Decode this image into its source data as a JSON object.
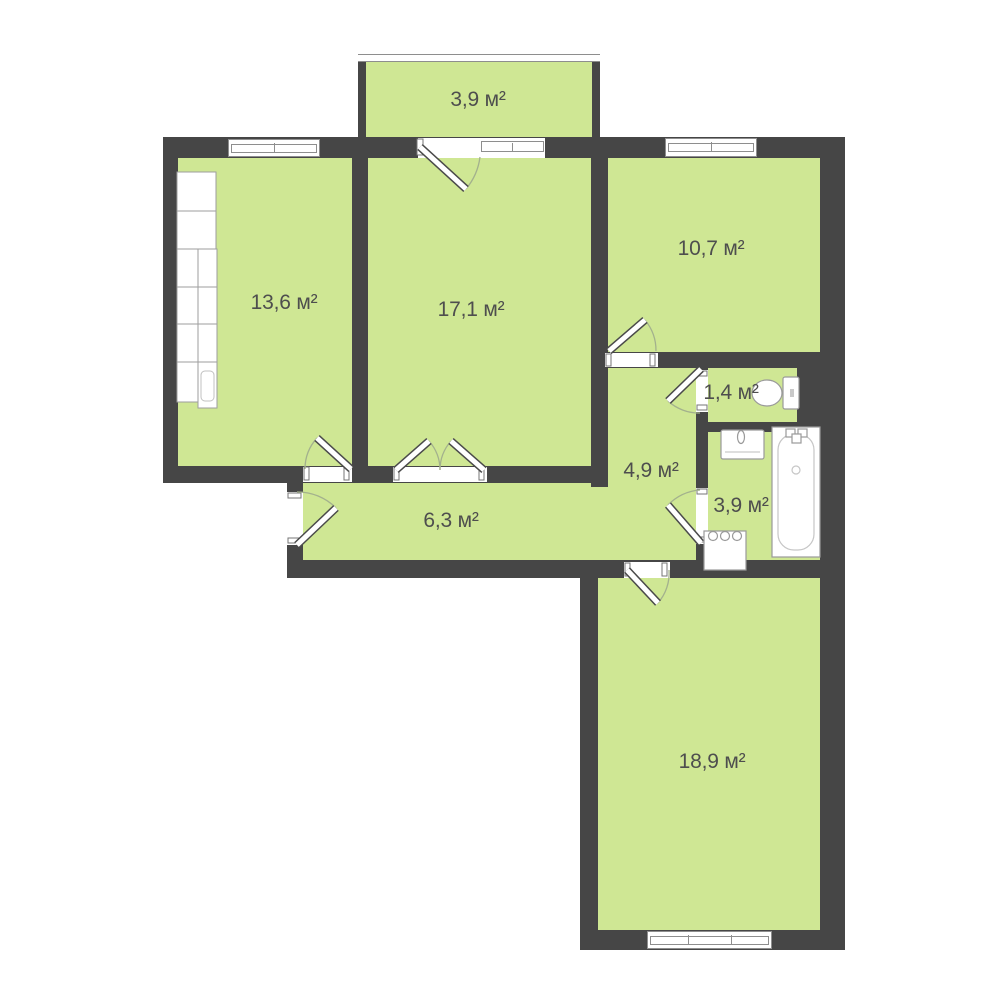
{
  "plan_title": "Apartment floor plan",
  "area_unit": "м²",
  "colors": {
    "wall": "#464646",
    "floor": "#cfe794",
    "background": "#ffffff",
    "label": "#4e4e4e"
  },
  "rooms": [
    {
      "name": "balcony",
      "area": "3,9 м²"
    },
    {
      "name": "kitchen",
      "area": "13,6 м²"
    },
    {
      "name": "room-17",
      "area": "17,1 м²"
    },
    {
      "name": "room-10",
      "area": "10,7 м²"
    },
    {
      "name": "wc",
      "area": "1,4 м²"
    },
    {
      "name": "hallway",
      "area": "4,9 м²"
    },
    {
      "name": "bathroom",
      "area": "3,9 м²"
    },
    {
      "name": "corridor",
      "area": "6,3 м²"
    },
    {
      "name": "living-room",
      "area": "18,9 м²"
    }
  ],
  "fixtures": [
    "kitchen-units",
    "toilet",
    "sink",
    "bathtub",
    "washing-machine"
  ]
}
